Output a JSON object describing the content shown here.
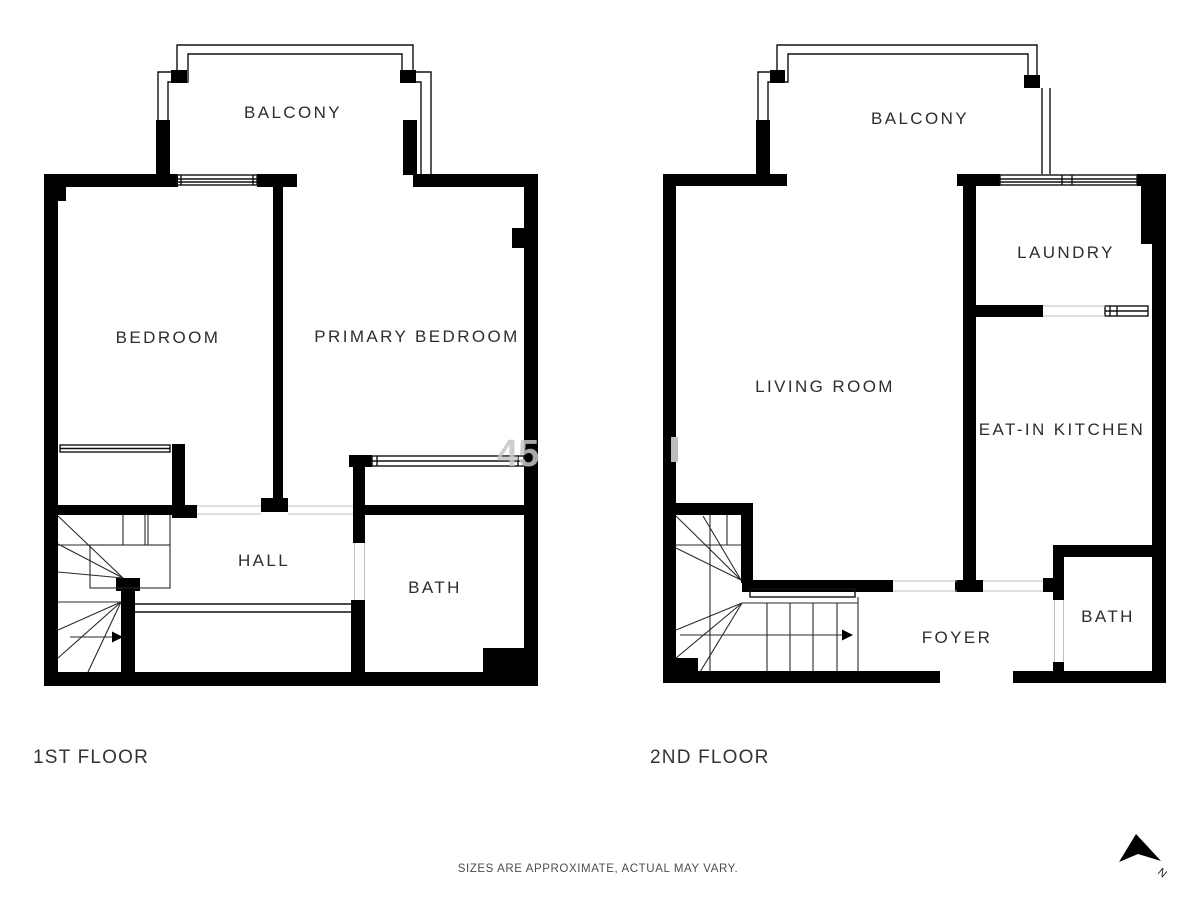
{
  "floors": [
    {
      "title": "1ST FLOOR",
      "rooms": {
        "balcony": "BALCONY",
        "bedroom": "BEDROOM",
        "primary_bedroom": "PRIMARY BEDROOM",
        "hall": "HALL",
        "bath": "BATH"
      }
    },
    {
      "title": "2ND FLOOR",
      "rooms": {
        "balcony": "BALCONY",
        "living_room": "LIVING ROOM",
        "laundry": "LAUNDRY",
        "eat_in_kitchen": "EAT-IN KITCHEN",
        "foyer": "FOYER",
        "bath": "BATH"
      }
    }
  ],
  "footer": {
    "disclaimer": "SIZES ARE APPROXIMATE, ACTUAL MAY VARY."
  },
  "compass": {
    "north_label": "N"
  },
  "watermark": {
    "text": "45"
  },
  "colors": {
    "wall": "#000000",
    "label": "#2d2d2d",
    "muted": "#4d4d4d"
  }
}
